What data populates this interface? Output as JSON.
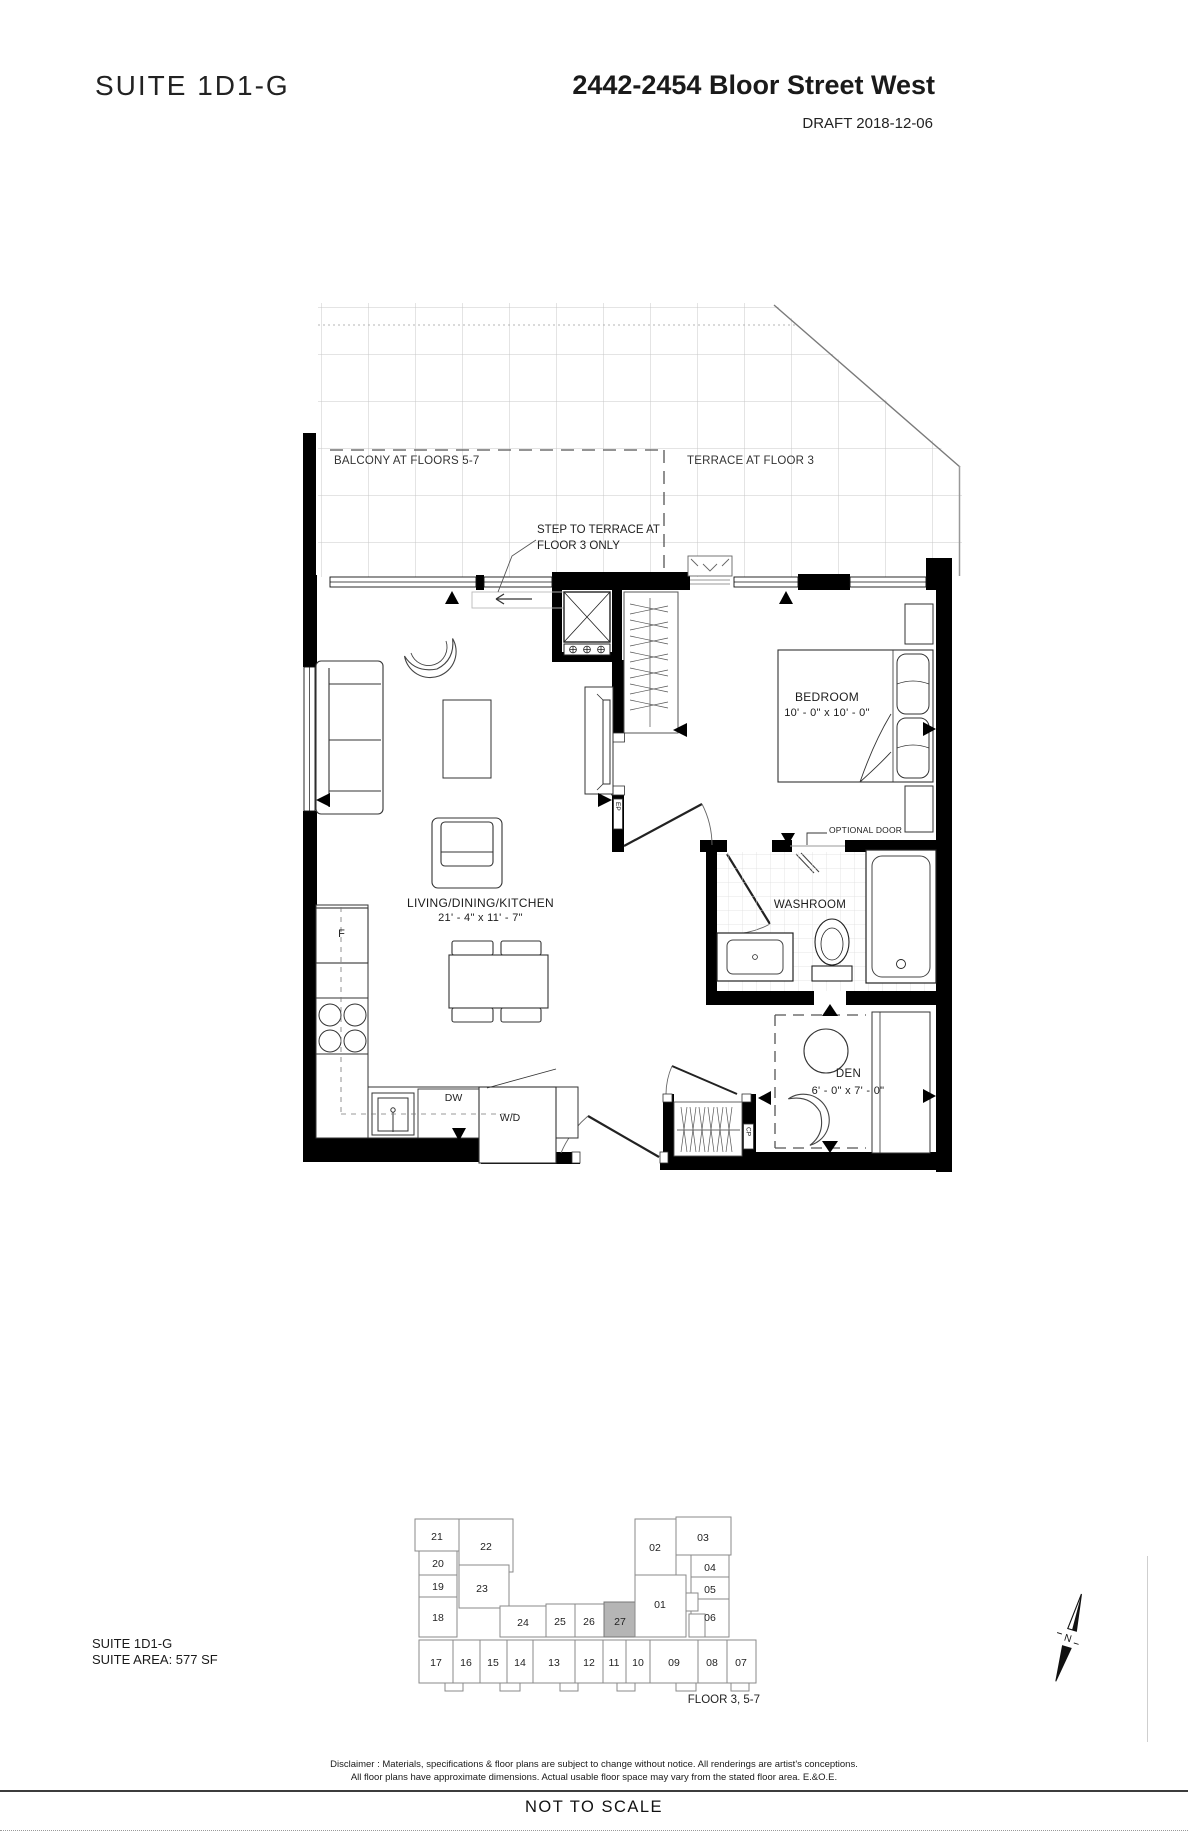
{
  "header": {
    "suite_title": "SUITE  1D1-G",
    "address": "2442-2454 Bloor Street West",
    "draft": "DRAFT 2018-12-06"
  },
  "plan": {
    "labels": {
      "balcony": "BALCONY AT FLOORS 5-7",
      "terrace": "TERRACE AT FLOOR 3",
      "step_line1": "STEP TO TERRACE AT",
      "step_line2": "FLOOR 3 ONLY",
      "bedroom": "BEDROOM",
      "bedroom_dims": "10' - 0\"  x  10' - 0\"",
      "living": "LIVING/DINING/KITCHEN",
      "living_dims": "21' - 4\"  x  11' - 7\"",
      "washroom": "WASHROOM",
      "den": "DEN",
      "den_dims": "6' - 0\"  x  7' - 0\"",
      "optional_door": "OPTIONAL DOOR",
      "fridge": "F",
      "dishwasher": "DW",
      "washer_dryer": "W/D",
      "electrical_panel": "EP",
      "closet_panel": "CP"
    }
  },
  "keyplan": {
    "floor_label": "FLOOR 3, 5-7",
    "highlighted_unit": "27",
    "highlight_color": "#b5b5b5",
    "units": [
      {
        "number": "21"
      },
      {
        "number": "20"
      },
      {
        "number": "19"
      },
      {
        "number": "18"
      },
      {
        "number": "22"
      },
      {
        "number": "23"
      },
      {
        "number": "24"
      },
      {
        "number": "25"
      },
      {
        "number": "26"
      },
      {
        "number": "27"
      },
      {
        "number": "02"
      },
      {
        "number": "03"
      },
      {
        "number": "01"
      },
      {
        "number": "04"
      },
      {
        "number": "05"
      },
      {
        "number": "06"
      },
      {
        "number": "17"
      },
      {
        "number": "16"
      },
      {
        "number": "15"
      },
      {
        "number": "14"
      },
      {
        "number": "13"
      },
      {
        "number": "12"
      },
      {
        "number": "11"
      },
      {
        "number": "10"
      },
      {
        "number": "09"
      },
      {
        "number": "08"
      },
      {
        "number": "07"
      }
    ]
  },
  "compass": {
    "label": "N"
  },
  "footer": {
    "suite_label": "SUITE  1D1-G",
    "suite_area": "SUITE AREA: 577 SF",
    "disclaimer_line1": "Disclaimer : Materials, specifications & floor plans are subject to change without notice. All renderings are artist's conceptions.",
    "disclaimer_line2": "All floor plans have approximate dimensions. Actual usable floor space may vary from the stated floor area. E.&O.E.",
    "not_to_scale": "NOT TO SCALE"
  }
}
